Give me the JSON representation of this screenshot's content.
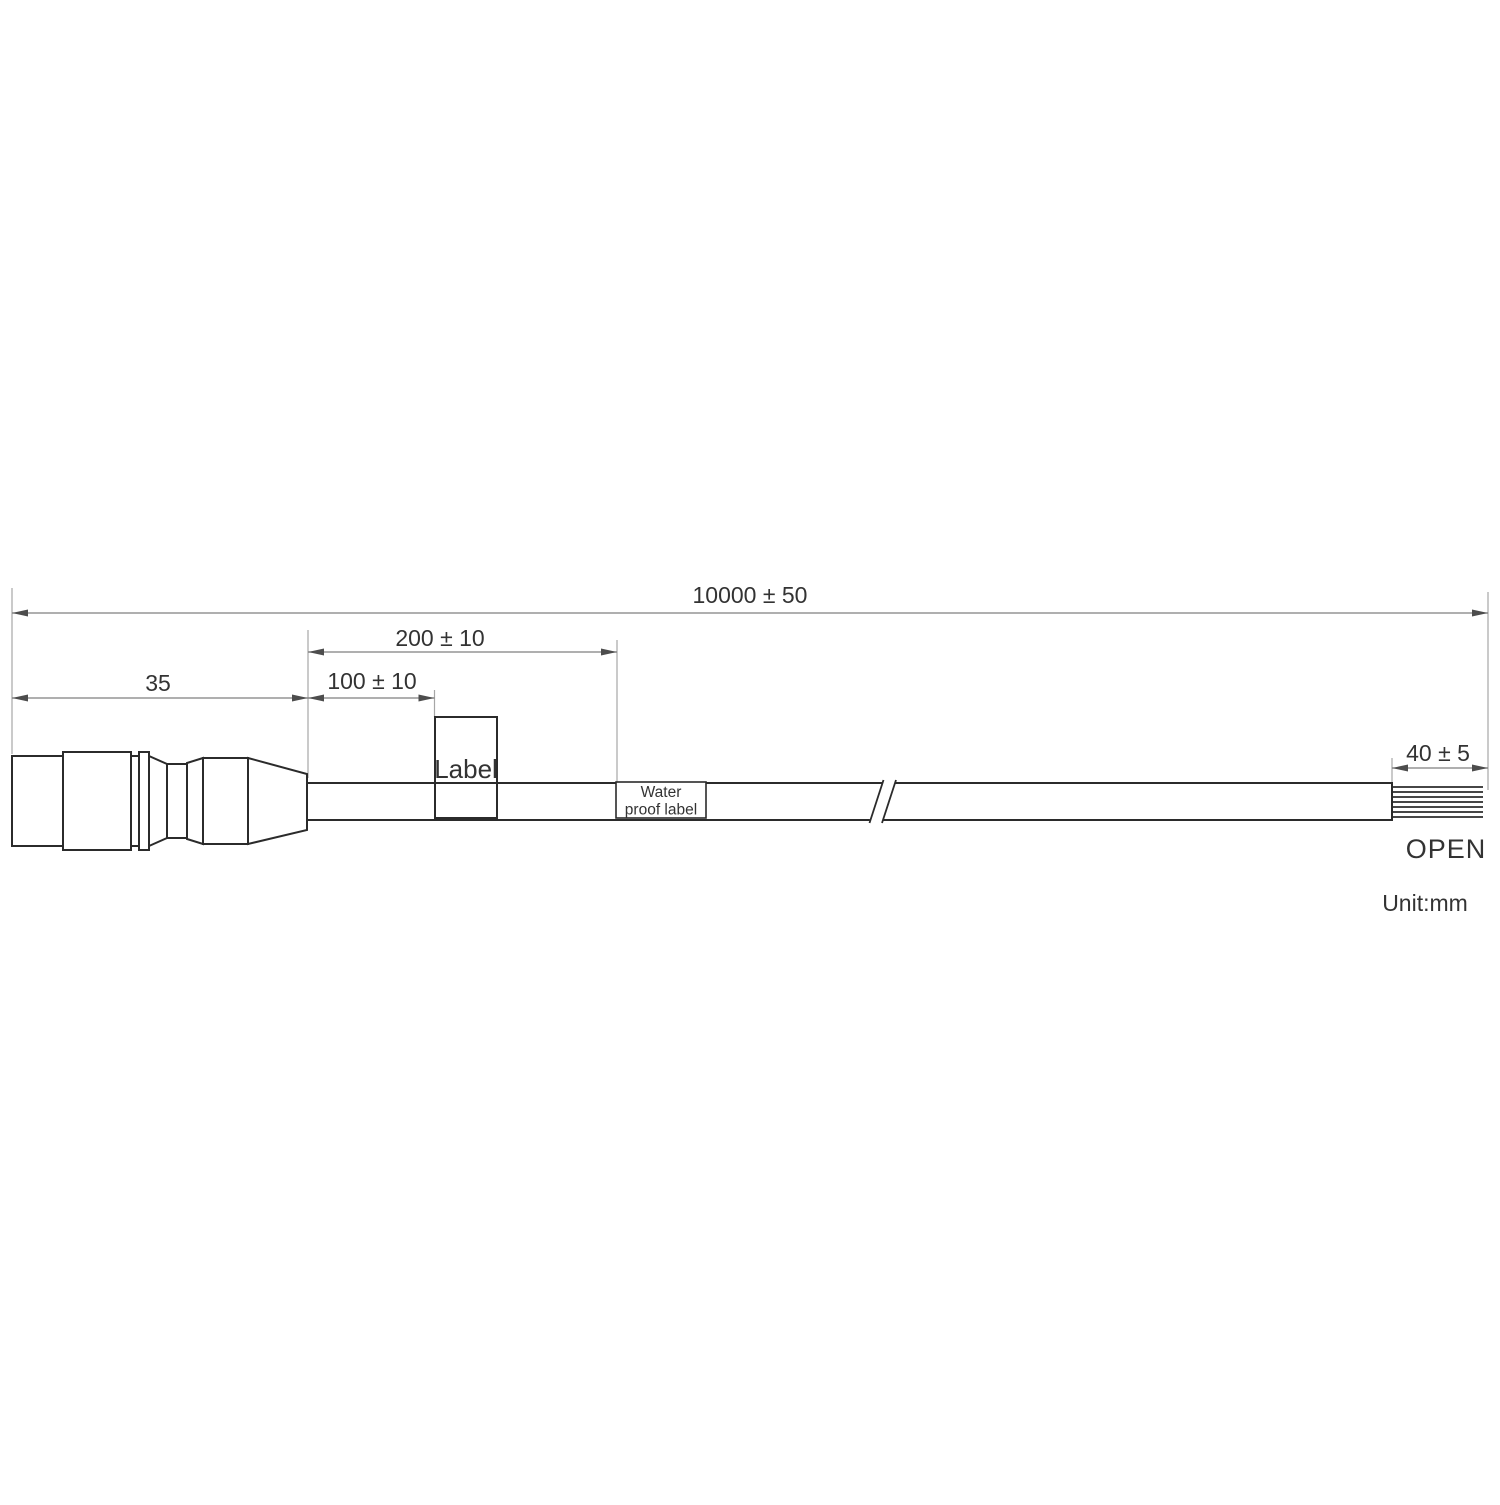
{
  "drawing": {
    "unit_note": "Unit:mm",
    "dimensions": {
      "overall": "10000 ± 50",
      "label_distance": "200 ± 10",
      "label_start": "100 ± 10",
      "connector_length": "35",
      "strip_length": "40 ± 5"
    },
    "labels": {
      "cable_label": "Label",
      "waterproof_line1": "Water",
      "waterproof_line2": "proof label",
      "open_end": "OPEN"
    },
    "colors": {
      "object_line": "#2b2b2b",
      "dimension_line": "#7f7f7f",
      "extension_line": "#a6a6a6",
      "arrow": "#4d4d4d",
      "text": "#333333",
      "background": "#ffffff"
    }
  }
}
